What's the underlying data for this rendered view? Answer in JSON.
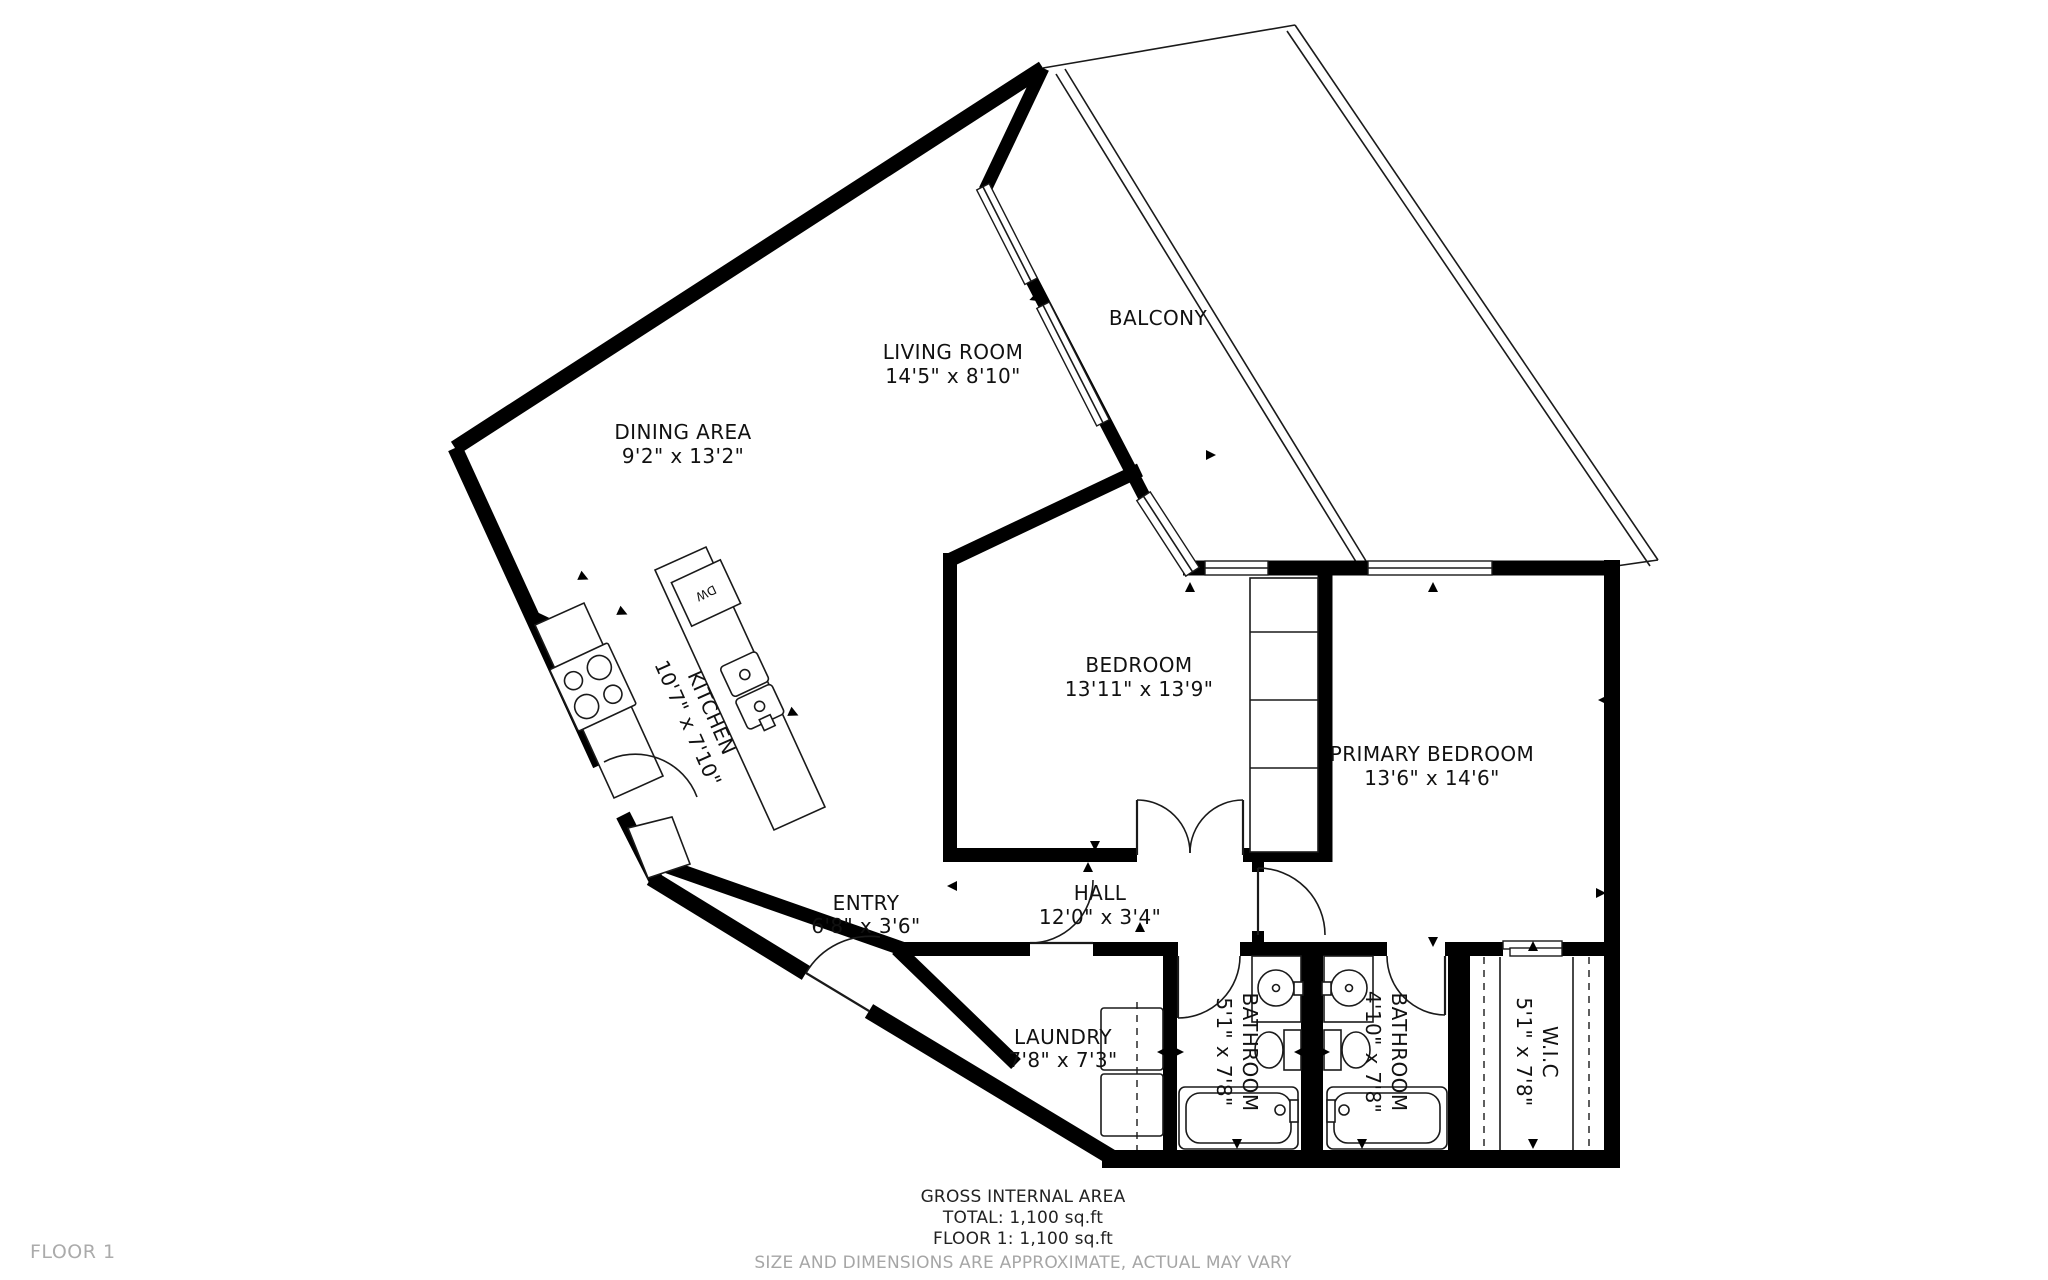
{
  "rooms": {
    "living": {
      "name": "LIVING ROOM",
      "dims": "14'5\" x 8'10\""
    },
    "dining": {
      "name": "DINING AREA",
      "dims": "9'2\" x 13'2\""
    },
    "balcony": {
      "name": "BALCONY",
      "dims": ""
    },
    "kitchen": {
      "name": "KITCHEN",
      "dims": "10'7\" x 7'10\""
    },
    "bedroom": {
      "name": "BEDROOM",
      "dims": "13'11\" x 13'9\""
    },
    "primary": {
      "name": "PRIMARY BEDROOM",
      "dims": "13'6\" x 14'6\""
    },
    "entry": {
      "name": "ENTRY",
      "dims": "6'8\" x 3'6\""
    },
    "hall": {
      "name": "HALL",
      "dims": "12'0\" x 3'4\""
    },
    "laundry": {
      "name": "LAUNDRY",
      "dims": "7'8\" x 7'3\""
    },
    "bathroom1": {
      "name": "BATHROOM",
      "dims": "5'1\" x 7'8\""
    },
    "bathroom2": {
      "name": "BATHROOM",
      "dims": "4'10\" x 7'8\""
    },
    "wic": {
      "name": "W.I.C",
      "dims": "5'1\" x 7'8\""
    }
  },
  "labels": {
    "dishwasher": "DW"
  },
  "footer": {
    "line1": "GROSS INTERNAL AREA",
    "line2": "TOTAL: 1,100 sq.ft",
    "line3": "FLOOR 1: 1,100 sq.ft",
    "disclaimer": "SIZE AND DIMENSIONS ARE APPROXIMATE, ACTUAL MAY VARY"
  },
  "floor_label": "FLOOR 1",
  "colors": {
    "wall": "#000000",
    "text": "#111111",
    "muted": "#a6a6a6",
    "background": "#ffffff"
  }
}
